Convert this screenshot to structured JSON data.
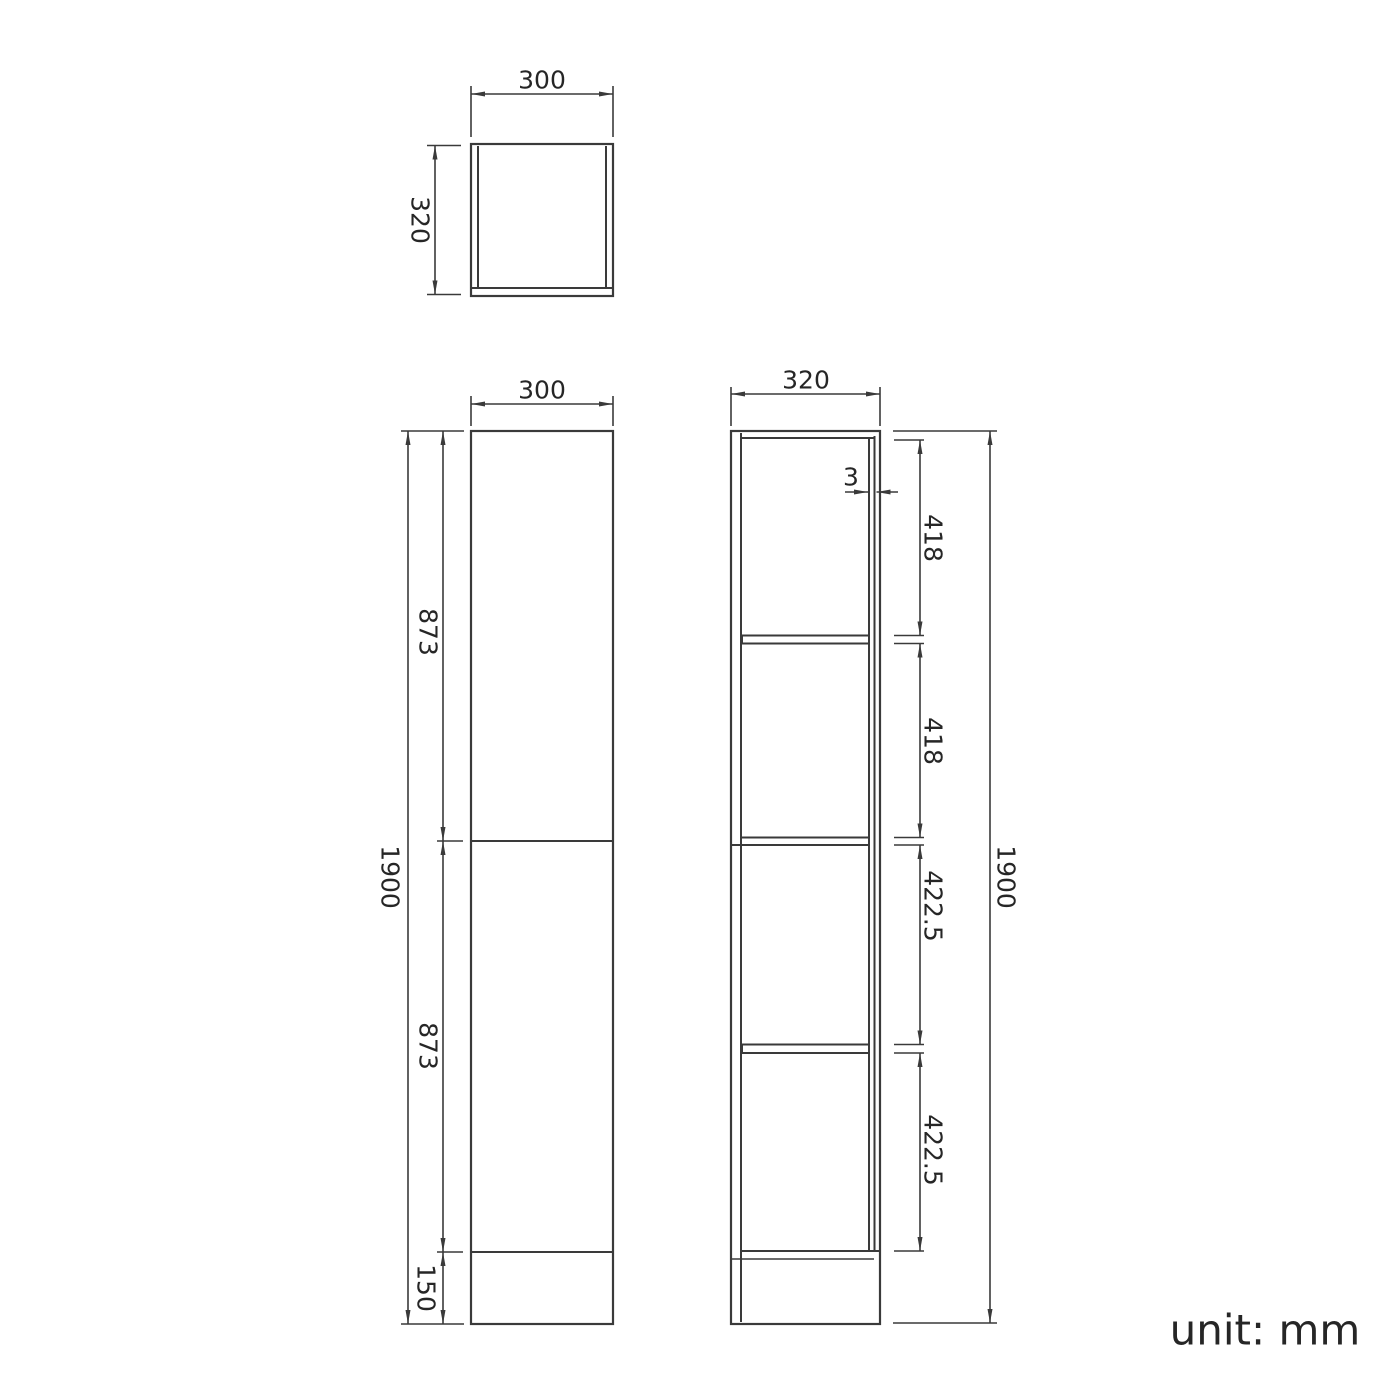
{
  "unit_label": "unit: mm",
  "colors": {
    "background": "#ffffff",
    "line": "#3a3a3a",
    "dimension": "#3a3a3a",
    "text": "#262626"
  },
  "views": {
    "top_view": {
      "width": "300",
      "depth": "320"
    },
    "front_view": {
      "width": "300",
      "total_height": "1900",
      "upper_door_height": "873",
      "lower_door_height": "873",
      "plinth_height": "150"
    },
    "side_view": {
      "depth": "320",
      "door_gap": "3",
      "total_height": "1900",
      "compartment_heights": [
        "418",
        "418",
        "422.5",
        "422.5"
      ]
    }
  }
}
